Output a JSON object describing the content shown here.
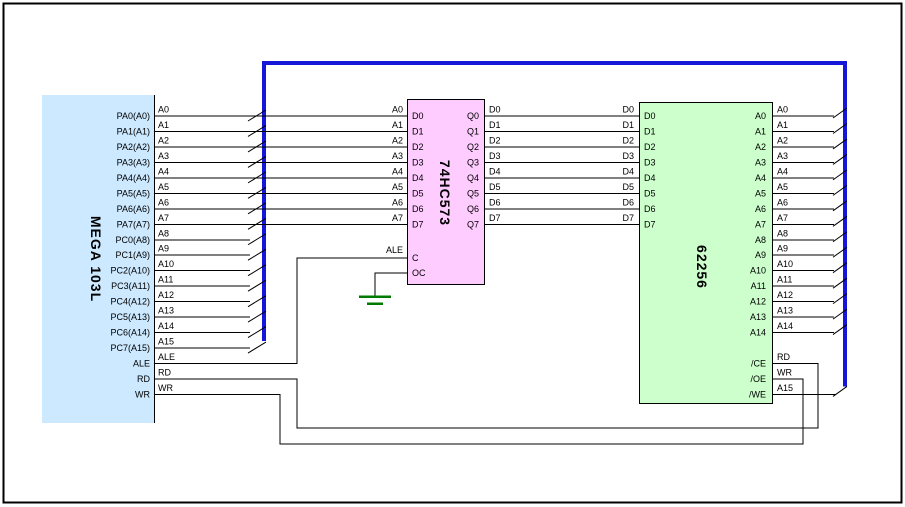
{
  "colors": {
    "background": "#ffffff",
    "frame": "#000000",
    "wire": "#000000",
    "bus": "#1616d9",
    "ground": "#007a00",
    "mcu_fill": "#cce9ff",
    "latch_fill": "#ffccff",
    "sram_fill": "#ccffcc"
  },
  "chips": [
    {
      "key": "mega103l",
      "title": "MEGA 103L",
      "fill_key": "mcu_fill",
      "pins_right": [
        "PA0(A0)",
        "PA1(A1)",
        "PA2(A2)",
        "PA3(A3)",
        "PA4(A4)",
        "PA5(A5)",
        "PA6(A6)",
        "PA7(A7)",
        "PC0(A8)",
        "PC1(A9)",
        "PC2(A10)",
        "PC3(A11)",
        "PC4(A12)",
        "PC5(A13)",
        "PC6(A14)",
        "PC7(A15)",
        "ALE",
        "RD",
        "WR"
      ]
    },
    {
      "key": "74hc573",
      "title": "74HC573",
      "fill_key": "latch_fill",
      "pins_left": [
        "D0",
        "D1",
        "D2",
        "D3",
        "D4",
        "D5",
        "D6",
        "D7",
        "C",
        "OC"
      ],
      "pins_right": [
        "Q0",
        "Q1",
        "Q2",
        "Q3",
        "Q4",
        "Q5",
        "Q6",
        "Q7"
      ]
    },
    {
      "key": "62256",
      "title": "62256",
      "fill_key": "sram_fill",
      "pins_left": [
        "D0",
        "D1",
        "D2",
        "D3",
        "D4",
        "D5",
        "D6",
        "D7"
      ],
      "pins_right": [
        "A0",
        "A1",
        "A2",
        "A3",
        "A4",
        "A5",
        "A6",
        "A7",
        "A8",
        "A9",
        "A10",
        "A11",
        "A12",
        "A13",
        "A14",
        "/CE",
        "/OE",
        "/WE"
      ]
    }
  ],
  "net_labels": {
    "mcu_side": [
      "A0",
      "A1",
      "A2",
      "A3",
      "A4",
      "A5",
      "A6",
      "A7",
      "A8",
      "A9",
      "A10",
      "A11",
      "A12",
      "A13",
      "A14",
      "A15",
      "ALE",
      "RD",
      "WR"
    ],
    "latch_in_side": [
      "A0",
      "A1",
      "A2",
      "A3",
      "A4",
      "A5",
      "A6",
      "A7"
    ],
    "latch_clock": "ALE",
    "latch_out_side": [
      "D0",
      "D1",
      "D2",
      "D3",
      "D4",
      "D5",
      "D6",
      "D7"
    ],
    "sram_data_side": [
      "D0",
      "D1",
      "D2",
      "D3",
      "D4",
      "D5",
      "D6",
      "D7"
    ],
    "sram_addr_side": [
      "A0",
      "A1",
      "A2",
      "A3",
      "A4",
      "A5",
      "A6",
      "A7",
      "A8",
      "A9",
      "A10",
      "A11",
      "A12",
      "A13",
      "A14"
    ],
    "sram_ctrl": [
      "RD",
      "WR",
      "A15"
    ]
  }
}
